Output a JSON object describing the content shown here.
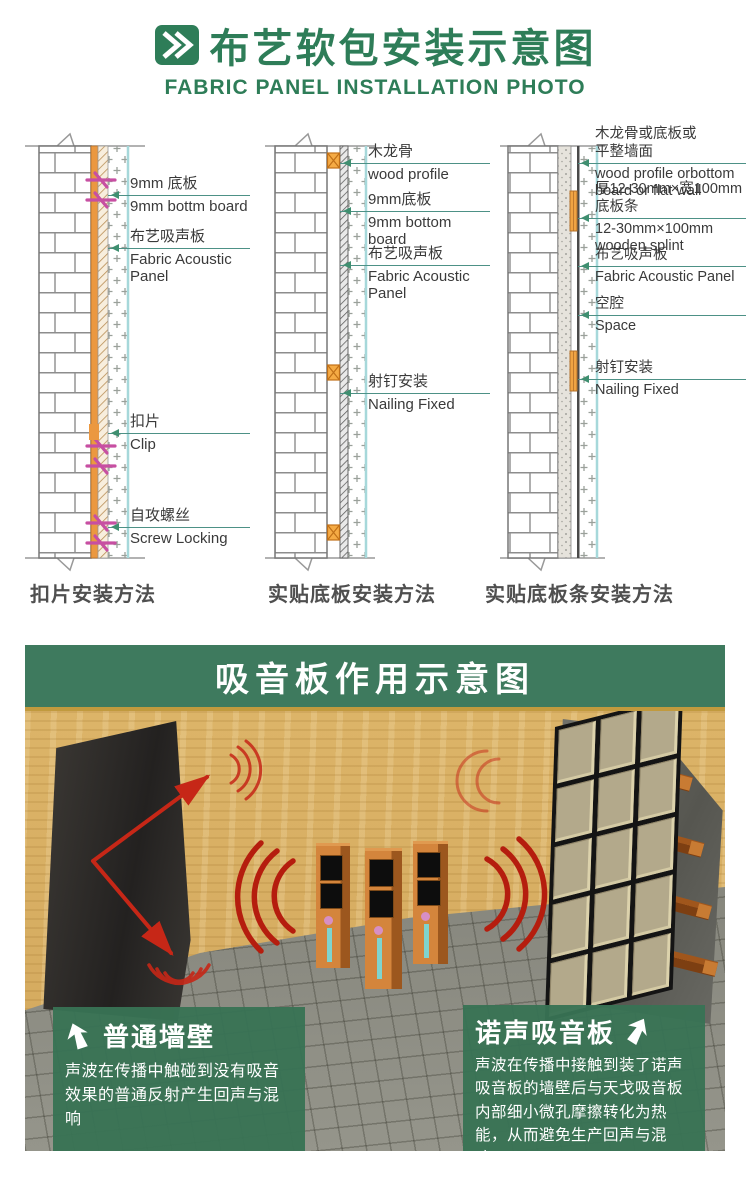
{
  "header": {
    "title_zh": "布艺软包安装示意图",
    "title_en": "FABRIC PANEL INSTALLATION PHOTO"
  },
  "diagrams": [
    {
      "caption": "扣片安装方法",
      "labels": [
        {
          "zh": "9mm 底板",
          "en": "9mm bottm board"
        },
        {
          "zh": "布艺吸声板",
          "en": "Fabric Acoustic Panel"
        },
        {
          "zh": "扣片",
          "en": "Clip"
        },
        {
          "zh": "自攻螺丝",
          "en": "Screw Locking"
        }
      ]
    },
    {
      "caption": "实贴底板安装方法",
      "labels": [
        {
          "zh": "木龙骨",
          "en": "wood profile"
        },
        {
          "zh": "9mm底板",
          "en": "9mm bottom board"
        },
        {
          "zh": "布艺吸声板",
          "en": "Fabric Acoustic Panel"
        },
        {
          "zh": "射钉安装",
          "en": "Nailing Fixed"
        }
      ]
    },
    {
      "caption": "实贴底板条安装方法",
      "labels": [
        {
          "zh": "木龙骨或底板或平整墙面",
          "en": "wood profile orbottom board or flat wall"
        },
        {
          "zh": "厚12-30mm×宽100mm底板条",
          "en": "12-30mm×100mm wooden splint"
        },
        {
          "zh": "布艺吸声板",
          "en": "Fabric Acoustic Panel"
        },
        {
          "zh": "空腔",
          "en": "Space"
        },
        {
          "zh": "射钉安装",
          "en": "Nailing Fixed"
        }
      ]
    }
  ],
  "illustration": {
    "banner": "吸音板作用示意图",
    "left_callout": {
      "heading": "普通墙壁",
      "body": "声波在传播中触碰到没有吸音效果的普通反射产生回声与混响"
    },
    "right_callout": {
      "heading": "诺声吸音板",
      "body": "声波在传播中接触到装了诺声吸音板的墙壁后与天戈吸音板内部细小微孔摩擦转化为热能，从而避免生产回声与混响。"
    }
  },
  "colors": {
    "brand_green": "#2e7d58",
    "banner_green": "#3e7a5e",
    "label_line_teal": "#4d9186",
    "accent_orange": "#eb9840",
    "clip_magenta": "#c74fa2",
    "sound_red": "#c62717"
  }
}
